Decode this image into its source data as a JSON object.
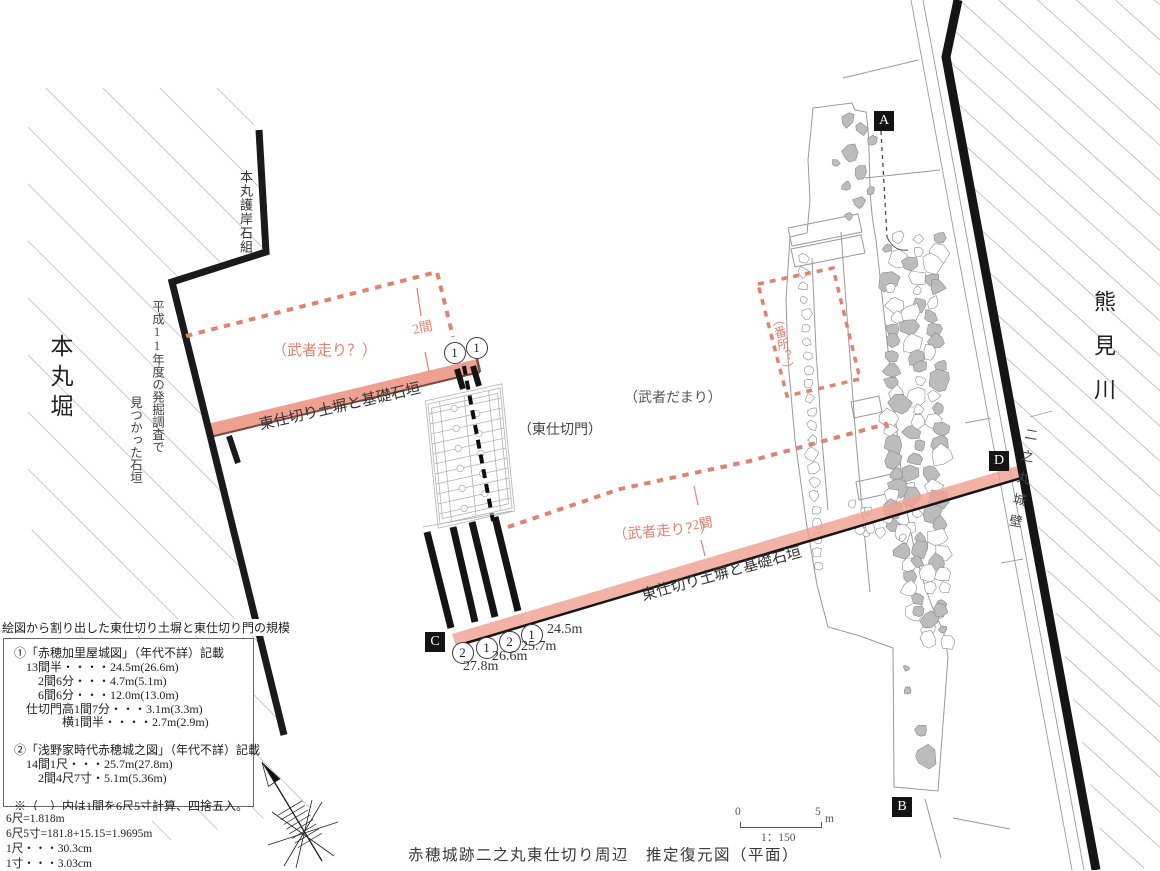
{
  "title": "赤穂城跡二之丸東仕切り周辺　推定復元図（平面）",
  "area_labels": {
    "honmaru_moat": "本丸堀",
    "honmaru_revetment": "本丸護岸石組",
    "excavation_note_1": "平成11年度の発掘調査で",
    "excavation_note_2": "見つかった石垣",
    "kumami_river": "熊見川",
    "ninomaru_wall": "二之丸城壁",
    "musha_damari": "（武者だまり）",
    "east_gate": "（東仕切門）",
    "bansho": "（番所？）",
    "musha_bashiri_upper": "（武者走り？）",
    "musha_bashiri_lower": "（武者走り？）",
    "wall_caption_upper": "東仕切り土塀と基礎石垣",
    "wall_caption_lower": "東仕切り土塀と基礎石垣",
    "span_upper": "2間",
    "span_lower": "2間"
  },
  "markers": {
    "a": "A",
    "b": "B",
    "c": "C",
    "d": "D"
  },
  "ref_circles_upper": [
    "1",
    "1"
  ],
  "measurements": [
    {
      "ref": "2",
      "value": "27.8m"
    },
    {
      "ref": "1",
      "value": "26.6m"
    },
    {
      "ref": "2",
      "value": "25.7m"
    },
    {
      "ref": "1",
      "value": "24.5m"
    }
  ],
  "info_box": {
    "heading": "絵図から割り出した東仕切り土塀と東仕切り門の規模",
    "lines": [
      "①「赤穂加里屋城図」（年代不詳）記載",
      "　13間半・・・・24.5m(26.6m)",
      "　　2間6分・・・4.7m(5.1m)",
      "　　6間6分・・・12.0m(13.0m)",
      "　仕切門高1間7分・・・3.1m(3.3m)",
      "　　　　横1間半・・・・2.7m(2.9m)",
      "",
      "②「浅野家時代赤穂城之図」（年代不詳）記載",
      "　14間1尺・・・25.7m(27.8m)",
      "　　2間4尺7寸・5.1m(5.36m)",
      "",
      "※（　）内は1間を6尺5寸計算、四捨五入。"
    ]
  },
  "conversions": [
    "6尺=1.818m",
    "6尺5寸=181.8+15.15=1.9695m",
    "1尺・・・30.3cm",
    "1寸・・・3.03cm"
  ],
  "scale_bar": {
    "start": "0",
    "end": "5",
    "unit": "m",
    "ratio": "1：150"
  },
  "colors": {
    "accent_pink": "#e08272",
    "bar_fill": "#efa191",
    "bar_edge_dark": "#7a4a42",
    "hatch_gray": "#c4c4c4",
    "wall_black": "#151515"
  }
}
